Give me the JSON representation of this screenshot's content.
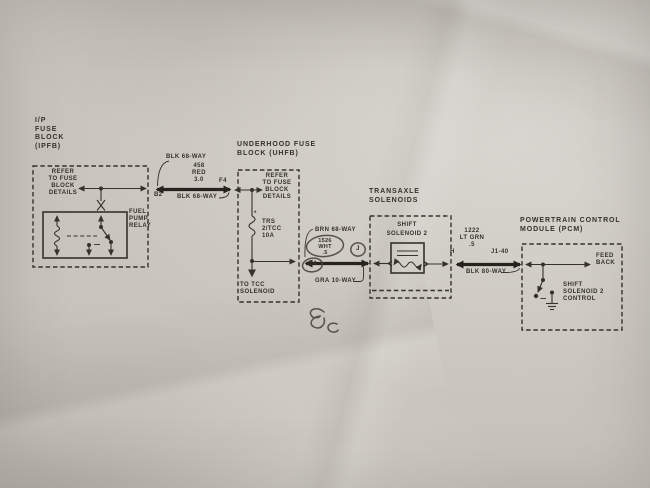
{
  "colors": {
    "paper": "#c9c5bd",
    "ink": "#35312b",
    "wire": "#26231f",
    "pen": "#4a453f"
  },
  "diagram": {
    "ipfb": {
      "title": "I/P\nFUSE\nBLOCK\n(IPFB)",
      "refer_note": "REFER\nTO FUSE\nBLOCK\nDETAILS",
      "relay_label": "FUEL\nPUMP\nRELAY"
    },
    "wire_ipfb_uhfb": {
      "top_label": "BLK 68-WAY",
      "circuit_label": "458\nRED\n3.0",
      "left_pin": "B2",
      "right_pin": "F4",
      "bottom_label": "BLK 68-WAY"
    },
    "uhfb": {
      "title": "UNDERHOOD FUSE\nBLOCK (UHFB)",
      "refer_note": "REFER\nTO FUSE\nBLOCK\nDETAILS",
      "fuse_footnote": "*",
      "fuse_label": "TRS\n2/TCC\n10A",
      "branch_note": "TO TCC\nSOLENOID"
    },
    "wire_uhfb_transaxle": {
      "top_label": "BRN 68-WAY",
      "circuit_label": "1526\nWHT\n.5",
      "left_pin": "B4",
      "inline_connector": "J",
      "bottom_label": "GRA 10-WAY"
    },
    "transaxle": {
      "title": "TRANSAXLE\nSOLENOIDS",
      "solenoid_label": "SHIFT\nSOLENOID 2"
    },
    "wire_transaxle_pcm": {
      "left_pin": "H",
      "circuit_label": "1222\nLT GRN\n.5",
      "right_pin": "J1-40",
      "bottom_label": "BLK 80-WAY"
    },
    "pcm": {
      "title": "POWERTRAIN CONTROL\nMODULE (PCM)",
      "feedback_label": "FEED\nBACK",
      "control_label": "SHIFT\nSOLENOID 2\nCONTROL"
    },
    "annotations": {
      "handwritten_note": "Bc"
    }
  }
}
